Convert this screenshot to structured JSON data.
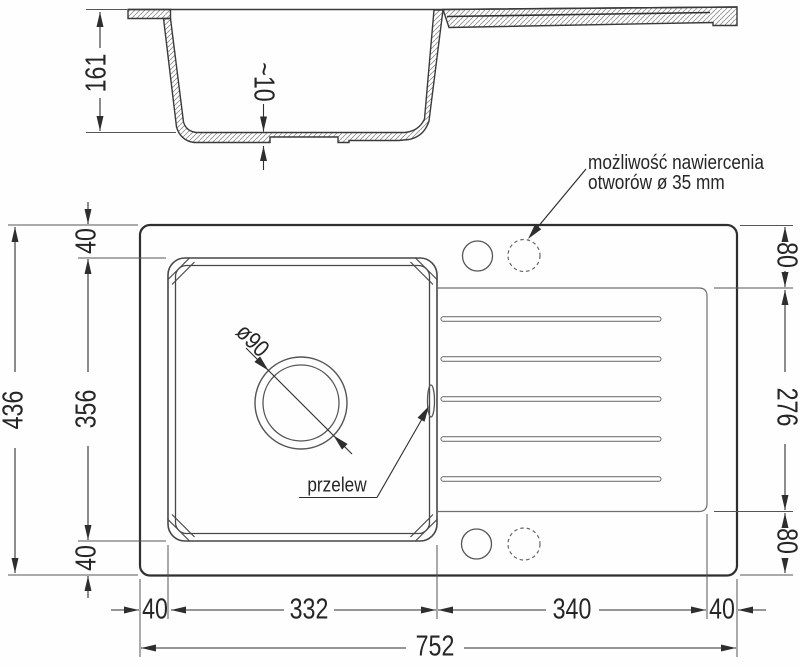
{
  "section_view": {
    "depth": "161",
    "bottom_thickness": "~10"
  },
  "plan_view": {
    "total_height": "436",
    "top_margin": "40",
    "bowl_height": "356",
    "bottom_margin": "40",
    "drainer_top_margin": "80",
    "drainer_height": "276",
    "drainer_bottom_margin": "80",
    "left_margin": "40",
    "bowl_width": "332",
    "drainer_width": "340",
    "right_margin": "40",
    "total_width": "752",
    "drain_diameter": "ø90",
    "overflow_label": "przelew",
    "drill_note": "możliwość nawiercenia\notworów ø 35 mm"
  },
  "colors": {
    "line": "#3a3a3a",
    "dimension": "#2e2e2e",
    "background": "#ffffff"
  }
}
